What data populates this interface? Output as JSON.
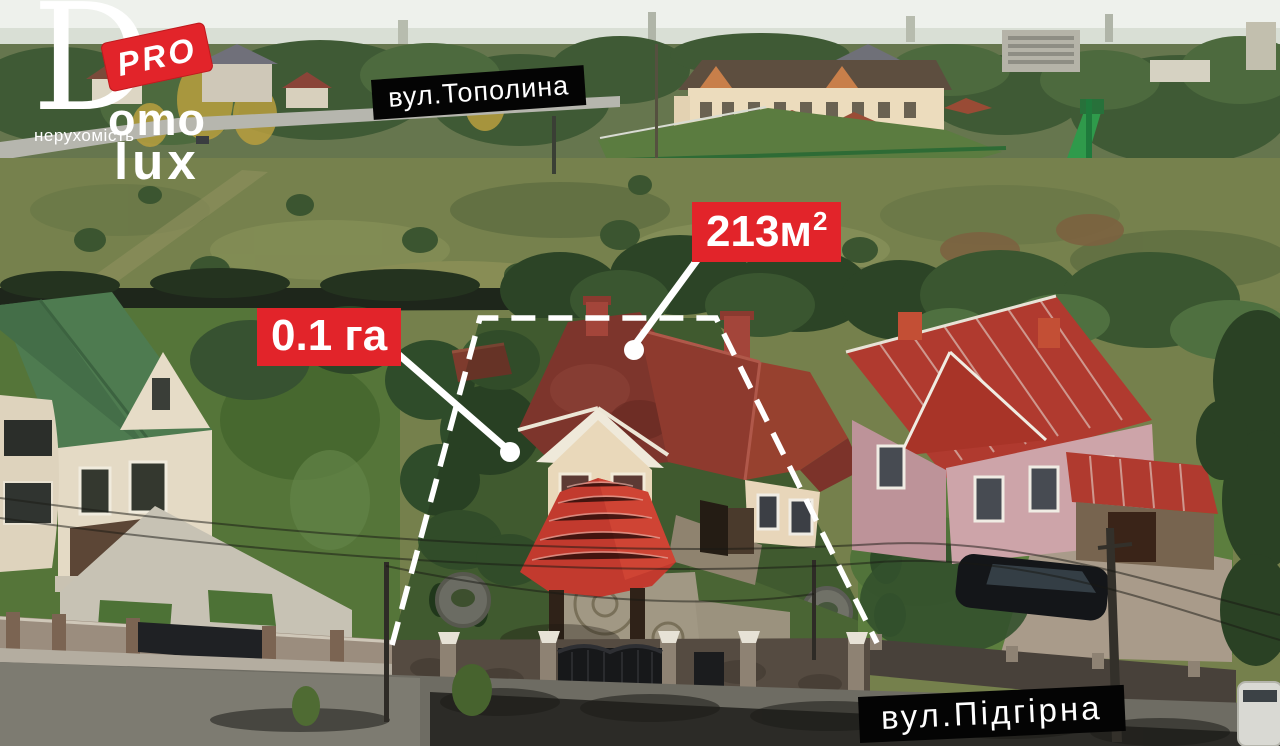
{
  "logo": {
    "d_letter": "D",
    "omo": "omo",
    "lux": "lux",
    "tagline": "нерухомість",
    "badge": "PRO"
  },
  "annotations": {
    "street_top": "вул.Тополина",
    "street_bottom": "вул.Підгірна",
    "house_area_value": "213м",
    "house_area_sup": "2",
    "land_area": "0.1 га"
  },
  "colors": {
    "accent_red": "#e2242a",
    "label_black": "#040404",
    "outline_white": "#ffffff"
  }
}
